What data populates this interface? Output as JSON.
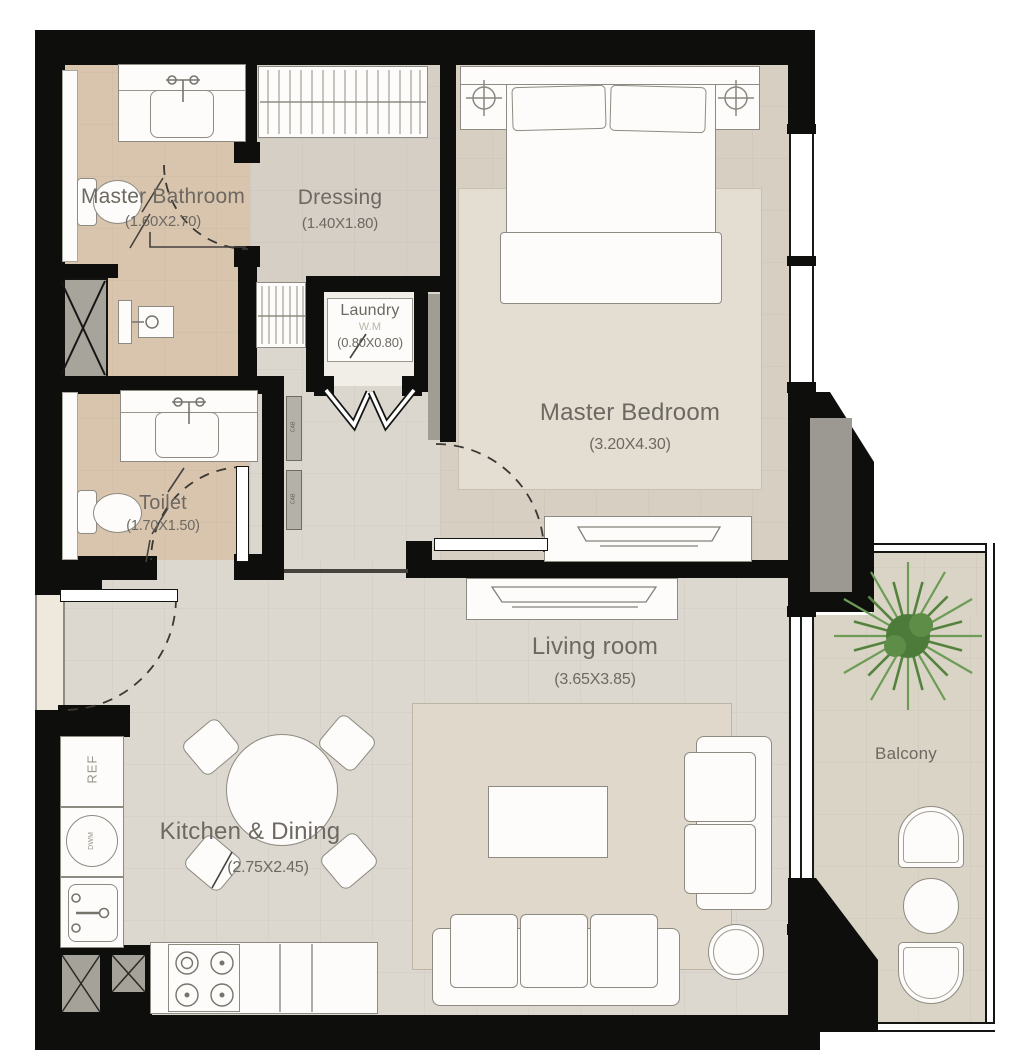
{
  "plan": {
    "rooms": {
      "master_bathroom": {
        "name": "Master Bathroom",
        "size": "(1.60X2.70)"
      },
      "dressing": {
        "name": "Dressing",
        "size": "(1.40X1.80)"
      },
      "laundry": {
        "name": "Laundry",
        "size": "(0.80X0.80)",
        "appliance": "W.M"
      },
      "master_bedroom": {
        "name": "Master Bedroom",
        "size": "(3.20X4.30)"
      },
      "toilet": {
        "name": "Toilet",
        "size": "(1.70X1.50)"
      },
      "living_room": {
        "name": "Living room",
        "size": "(3.65X3.85)"
      },
      "kitchen_dining": {
        "name": "Kitchen & Dining",
        "size": "(2.75X2.45)"
      },
      "balcony": {
        "name": "Balcony"
      }
    },
    "fixtures": {
      "refrigerator": "REF",
      "dishwasher": "DWM",
      "cabinet": "CAB"
    },
    "colors": {
      "wall": "#0e0e0c",
      "bathroom_floor": "#d9c5ae",
      "dressing_floor": "#d6cfc6",
      "bedroom_floor": "#d7cfc2",
      "living_floor": "#dcd8d0",
      "balcony_floor": "#dad4c6",
      "rug": "#e3ddd2",
      "palm_green": "#5c8a46",
      "label_text": "#6d6962"
    }
  }
}
